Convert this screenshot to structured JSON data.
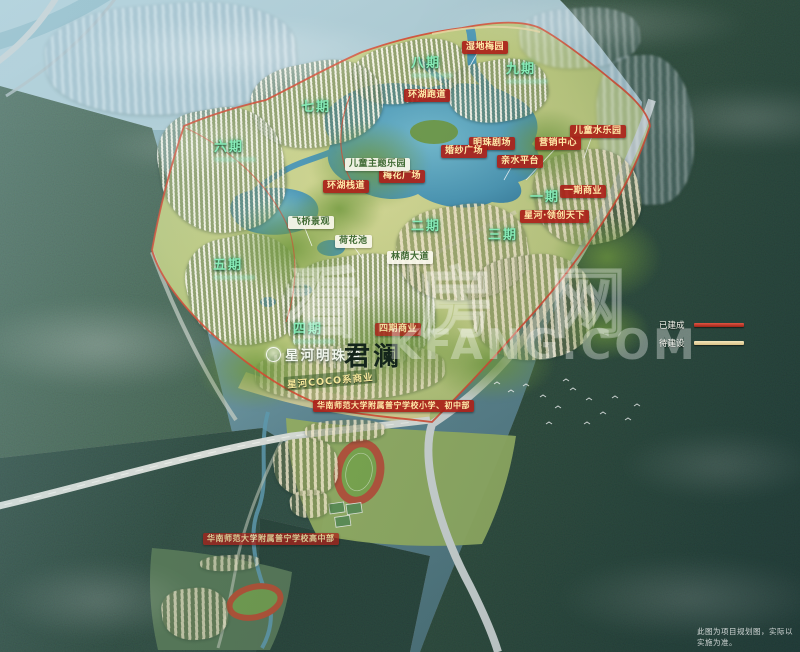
{
  "meta": {
    "disclaimer": "此图为项目规划图，实际以实施为准。"
  },
  "watermark": {
    "cn": "看房网",
    "en": "KFANG.COM"
  },
  "branding": {
    "logo_text": "星河明珠湾",
    "sub_brand": "君澜",
    "commercial_strip": "星河COCO系商业"
  },
  "legend": {
    "items": [
      {
        "label": "已建成",
        "color": "#c0392b"
      },
      {
        "label": "待建设",
        "color": "#e9d9a8"
      }
    ]
  },
  "map_labels": {
    "red": [
      {
        "text": "湿地梅园",
        "x": 462,
        "y": 41
      },
      {
        "text": "环湖跑道",
        "x": 404,
        "y": 89
      },
      {
        "text": "儿童水乐园",
        "x": 570,
        "y": 125
      },
      {
        "text": "明珠剧场",
        "x": 469,
        "y": 137
      },
      {
        "text": "营销中心",
        "x": 535,
        "y": 137
      },
      {
        "text": "婚纱广场",
        "x": 441,
        "y": 145
      },
      {
        "text": "亲水平台",
        "x": 497,
        "y": 155
      },
      {
        "text": "梅花广场",
        "x": 379,
        "y": 170
      },
      {
        "text": "环湖栈道",
        "x": 323,
        "y": 180
      },
      {
        "text": "一期商业",
        "x": 560,
        "y": 185
      },
      {
        "text": "星河·领创天下",
        "x": 520,
        "y": 210
      },
      {
        "text": "四期商业",
        "x": 375,
        "y": 323,
        "opacity": 0.88
      },
      {
        "text": "华南师范大学附属普宁学校小学、初中部",
        "x": 313,
        "y": 400,
        "fs": 8
      },
      {
        "text": "华南师范大学附属普宁学校高中部",
        "x": 203,
        "y": 533,
        "fs": 8,
        "opacity": 0.8
      }
    ],
    "white": [
      {
        "text": "儿童主题乐园",
        "x": 345,
        "y": 158
      },
      {
        "text": "飞桥景观",
        "x": 288,
        "y": 216
      },
      {
        "text": "荷花池",
        "x": 335,
        "y": 235
      },
      {
        "text": "林荫大道",
        "x": 387,
        "y": 251
      }
    ],
    "phase": [
      {
        "text": "七期",
        "x": 301,
        "y": 100
      },
      {
        "text": "八期",
        "x": 411,
        "y": 56,
        "sub": true
      },
      {
        "text": "九期",
        "x": 506,
        "y": 62,
        "sub": true
      },
      {
        "text": "六期",
        "x": 214,
        "y": 140,
        "sub": true
      },
      {
        "text": "五期",
        "x": 213,
        "y": 258,
        "sub": true
      },
      {
        "text": "一期",
        "x": 530,
        "y": 190
      },
      {
        "text": "二期",
        "x": 411,
        "y": 219
      },
      {
        "text": "三期",
        "x": 488,
        "y": 228
      },
      {
        "text": "四期",
        "x": 293,
        "y": 322,
        "sub": true
      }
    ]
  }
}
